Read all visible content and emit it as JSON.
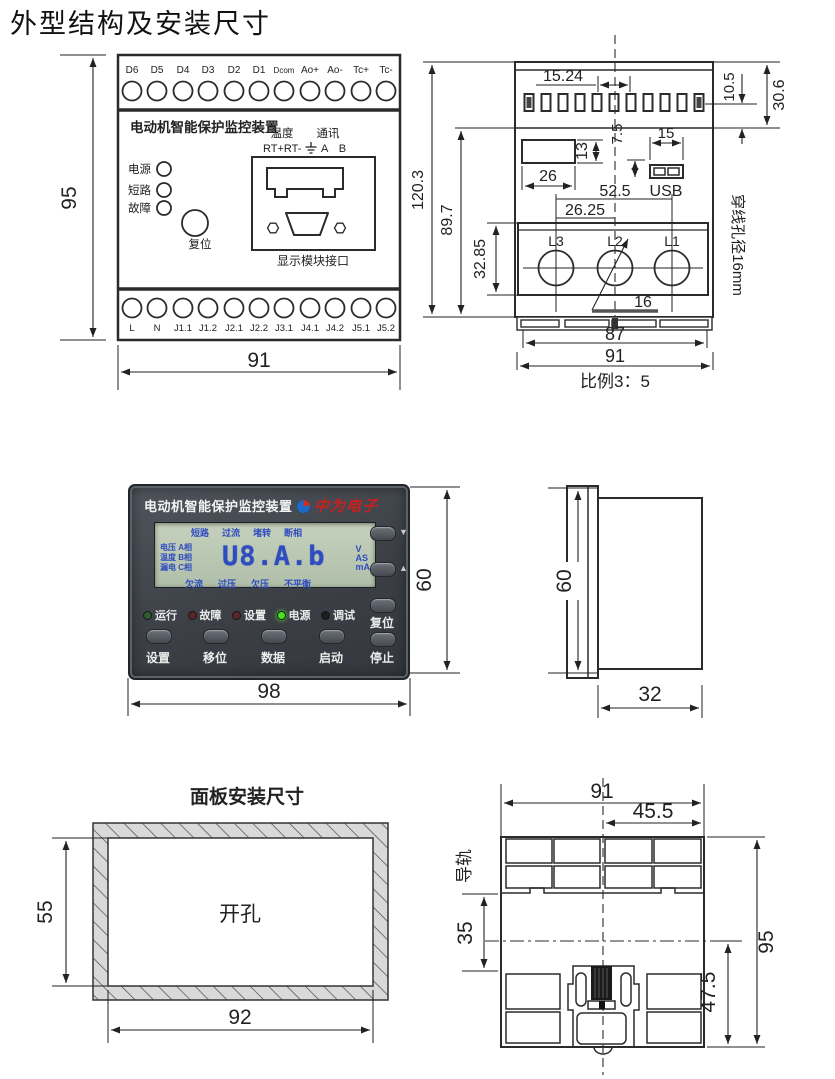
{
  "page": {
    "title": "外型结构及安装尺寸"
  },
  "front_view": {
    "top_terminals": [
      "D6",
      "D5",
      "D4",
      "D3",
      "D2",
      "D1",
      "Dcom",
      "Ao+",
      "Ao-",
      "Tc+",
      "Tc-"
    ],
    "bottom_terminals": [
      "L",
      "N",
      "J1.1",
      "J1.2",
      "J2.1",
      "J2.2",
      "J3.1",
      "J4.1",
      "J4.2",
      "J5.1",
      "J5.2"
    ],
    "device_label": "电动机智能保护监控装置",
    "temp_label": "温度",
    "comm_label": "通讯",
    "temp_pins": "RT+RT-",
    "comm_pins": "A B",
    "leds": [
      "电源",
      "短路",
      "故障"
    ],
    "reset_label": "复位",
    "port_label": "显示模块接口",
    "dim_height": "95",
    "dim_width": "91"
  },
  "top_view": {
    "dim_pitch": "15.24",
    "dim_top_right_1": "10.5",
    "dim_top_right_2": "30.6",
    "dim_window_w": "26",
    "dim_window_h": "13",
    "dim_usb_offset": "7.5",
    "dim_usb_w": "15",
    "usb_label": "USB",
    "dim_hole_span": "52.5",
    "dim_hole_half": "26.25",
    "dim_total_h": "120.3",
    "dim_body_h": "89.7",
    "dim_ct_h": "32.85",
    "hole_labels": [
      "L3",
      "L2",
      "L1"
    ],
    "dim_hole_d": "16",
    "dim_inner_w": "87",
    "dim_outer_w": "91",
    "scale_label": "比例3：5",
    "side_note": "穿线孔径16mm"
  },
  "panel": {
    "title": "电动机智能保护监控装置",
    "brand": "中为电子",
    "lcd": {
      "status_top": [
        "短路",
        "过流",
        "堵转",
        "断相"
      ],
      "rows_left": [
        "电压 A相",
        "温度 B相",
        "漏电 C相"
      ],
      "digits": "U8.A.b",
      "units": [
        "V",
        "AS",
        "mA"
      ],
      "status_bottom": [
        "欠流",
        "过压",
        "欠压",
        "不平衡"
      ]
    },
    "leds": [
      {
        "label": "运行",
        "color": "#2e5c2e"
      },
      {
        "label": "故障",
        "color": "#5c2626"
      },
      {
        "label": "设置",
        "color": "#5c2626"
      },
      {
        "label": "电源",
        "color": "#49e421"
      },
      {
        "label": "调试",
        "color": "#1d1d1d"
      }
    ],
    "buttons": [
      "设置",
      "移位",
      "数据",
      "启动",
      "停止"
    ],
    "reset_label": "复位",
    "arrows": {
      "down": "▼",
      "up": "▲"
    },
    "dim_height": "60",
    "dim_width": "98"
  },
  "side_view": {
    "dim_height": "60",
    "dim_depth": "32"
  },
  "cutout": {
    "title": "面板安装尺寸",
    "hole_label": "开孔",
    "dim_height": "55",
    "dim_width": "92"
  },
  "rail_view": {
    "dim_width": "91",
    "dim_half_width": "45.5",
    "rail_label": "导轨",
    "dim_rail_offset": "35",
    "dim_height": "95",
    "dim_lower": "47.5"
  }
}
